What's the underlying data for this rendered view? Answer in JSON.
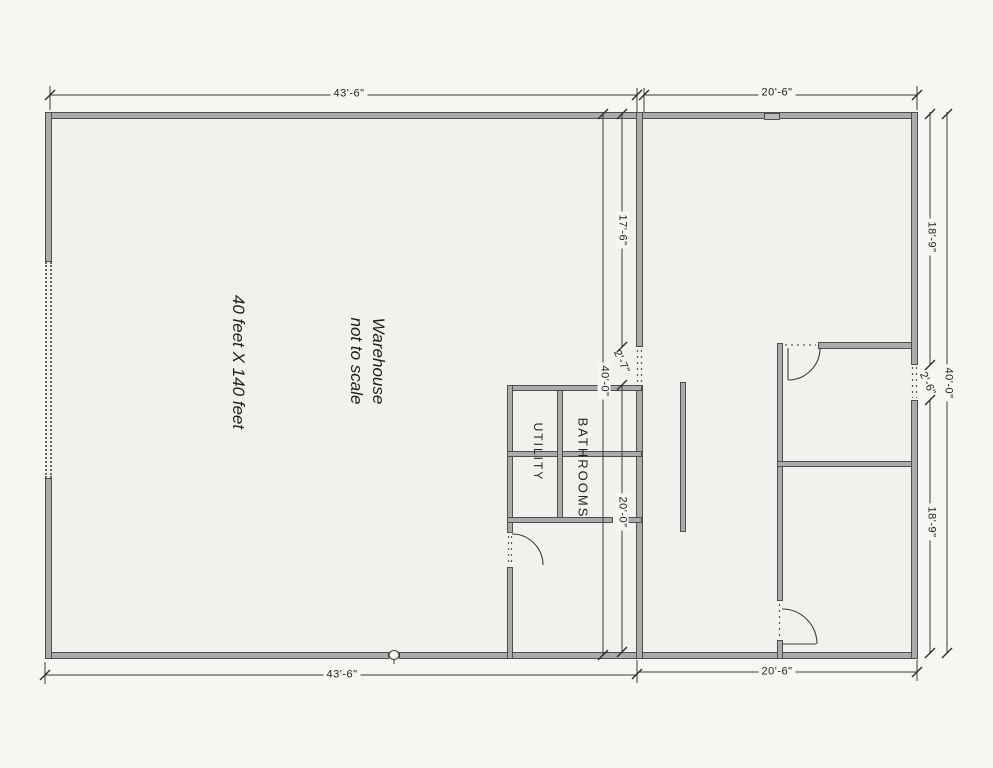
{
  "plan": {
    "warehouse_title": "Warehouse",
    "warehouse_subtitle": "not to scale",
    "warehouse_size": "40 feet X 140 feet",
    "rooms": {
      "utility": "UTILITY",
      "bathrooms": "BATHROOMS"
    }
  },
  "dimensions": {
    "top_left": "43'-6\"",
    "top_right": "20'-6\"",
    "bottom_left": "43'-6\"",
    "bottom_right": "20'-6\"",
    "center_upper": "17'-6\"",
    "center_door": "2'-7\"",
    "center_lower": "20'-0\"",
    "center_overall": "40'-0\"",
    "right_upper": "18'-9\"",
    "right_door": "2'-6\"",
    "right_lower": "18'-9\"",
    "right_overall": "40'-0\""
  },
  "colors": {
    "paper": "#f7f6f3",
    "plan-fill": "#f2f1ed",
    "wall-fill": "#ababab",
    "wall-edge": "#4e4e4e",
    "line": "#3a3a3a",
    "text": "#222222"
  }
}
